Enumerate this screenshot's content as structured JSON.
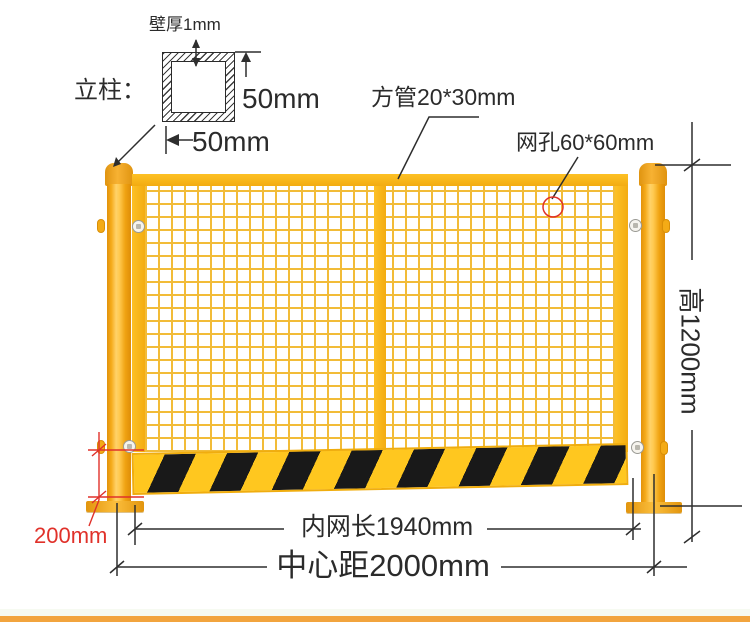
{
  "annotations": {
    "wall_thickness": "壁厚1mm",
    "post_prefix": "立柱：",
    "tube_height": "50mm",
    "tube_width": "50mm",
    "square_tube": "方管20*30mm",
    "mesh_hole": "网孔60*60mm",
    "fence_height": "高1200mm",
    "inner_net_length": "内网长1940mm",
    "center_distance": "中心距2000mm",
    "kickboard_height": "200mm"
  },
  "colors": {
    "fence_yellow": "#f3ac11",
    "post_orange_dark": "#de8d08",
    "post_orange_light": "#ffd269",
    "mesh_line_yellow": "#f2bc38",
    "stripe_yellow": "#ffc71f",
    "stripe_black": "#191919",
    "dimension_line_black": "#2e2e2e",
    "dimension_red": "#e0312a",
    "footer_orange": "#f2a43e"
  }
}
